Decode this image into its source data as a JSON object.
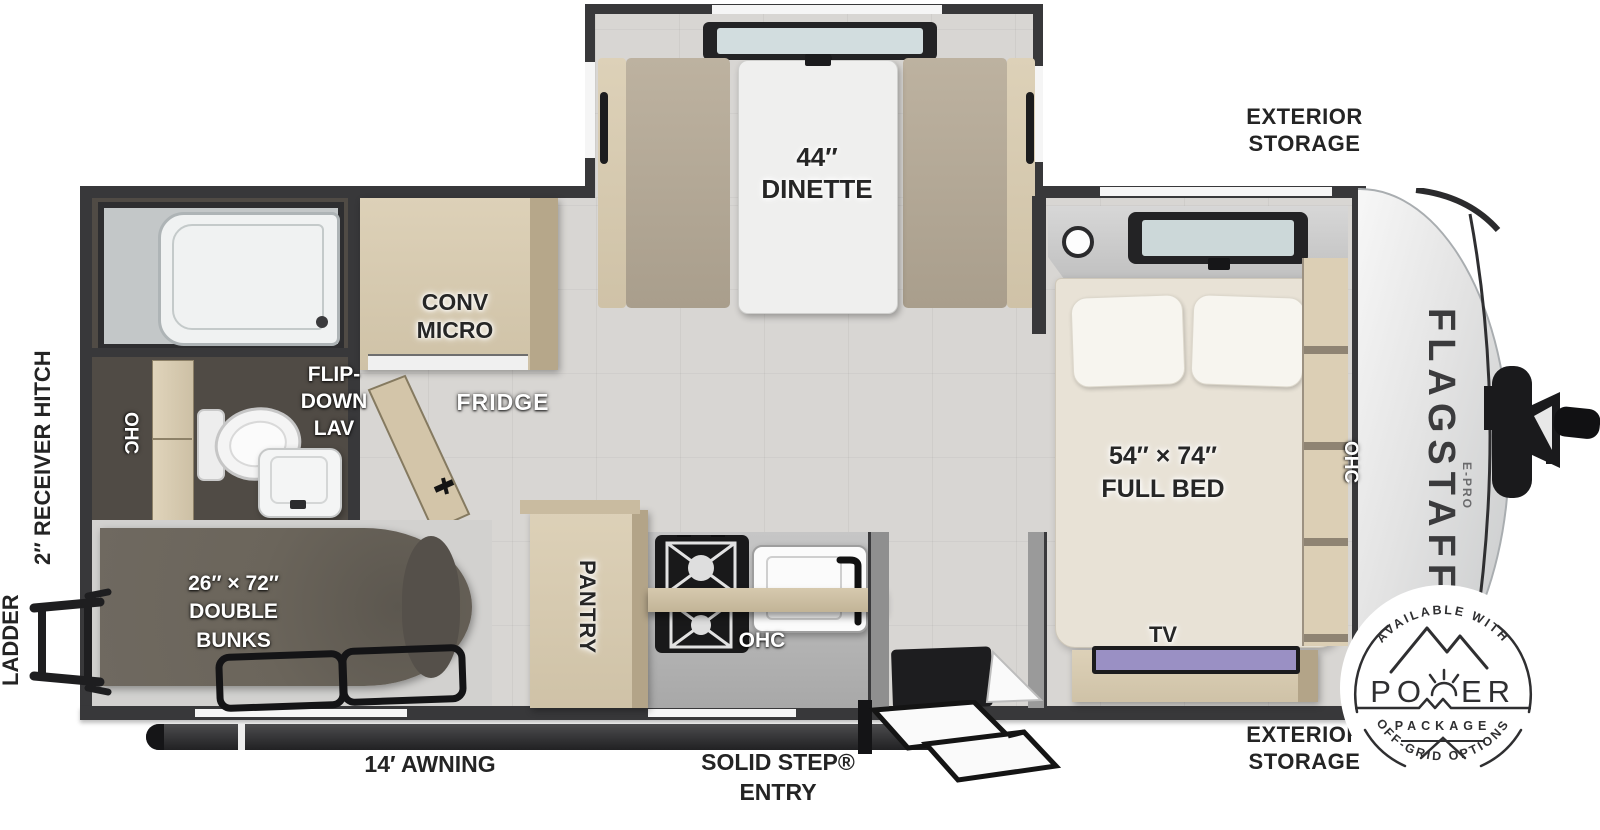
{
  "colors": {
    "wall": "#38383a",
    "floor": "#d8d6d3",
    "wood": "#d8cbb2",
    "cushion": "#b3a896",
    "bunk_mattress": "#676157",
    "bed_cream": "#e8e2d6",
    "tv_screen": "#9a90c4",
    "label_ink": "#262626",
    "badge_ink": "#2f2f31"
  },
  "brand": {
    "name": "FLAGSTAFF",
    "sub": "E-PRO"
  },
  "exterior": {
    "storage_top_l1": "EXTERIOR",
    "storage_top_l2": "STORAGE",
    "storage_bottom_l1": "EXTERIOR",
    "storage_bottom_l2": "STORAGE",
    "receiver_hitch": "2″ RECEIVER HITCH",
    "ladder": "LADDER",
    "awning": "14′ AWNING",
    "entry_l1": "SOLID STEP®",
    "entry_l2": "ENTRY"
  },
  "interior": {
    "dinette_l1": "44″",
    "dinette_l2": "DINETTE",
    "micro_l1": "CONV",
    "micro_l2": "MICRO",
    "fridge": "FRIDGE",
    "lav_l1": "FLIP-",
    "lav_l2": "DOWN",
    "lav_l3": "LAV",
    "ohc_bath": "OHC",
    "ohc_kitchen": "OHC",
    "ohc_bed": "OHC",
    "pantry": "PANTRY",
    "bunks_l1": "26″ × 72″",
    "bunks_l2": "DOUBLE",
    "bunks_l3": "BUNKS",
    "bed_l1": "54″ × 74″",
    "bed_l2": "FULL BED",
    "tv": "TV"
  },
  "badge": {
    "top": "AVAILABLE WITH",
    "power_left": "PO",
    "power_right": "ER",
    "package": "PACKAGE",
    "bottom": "OFF-GRID OPTIONS"
  }
}
